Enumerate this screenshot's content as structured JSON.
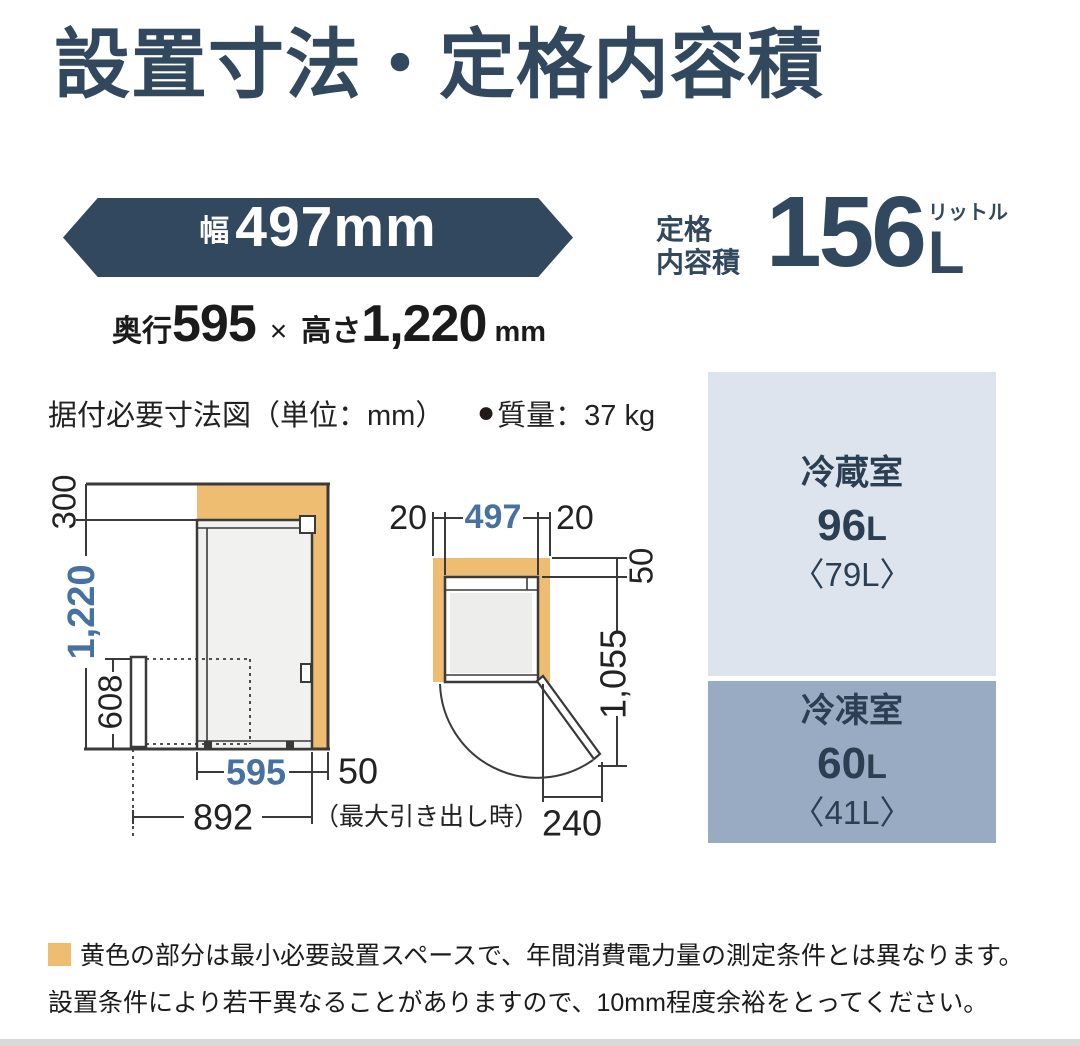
{
  "colors": {
    "accent_navy": "#32485e",
    "accent_blue": "#4671a1",
    "highlight_orange": "#eebd72",
    "fridge_box_bg": "#dde4ee",
    "freezer_box_bg": "#98abc2"
  },
  "header": {
    "title": "設置寸法・定格内容積"
  },
  "width_banner": {
    "label": "幅",
    "value": "497mm"
  },
  "other_dims": {
    "depth_label": "奥行",
    "depth": "595",
    "times": "×",
    "height_label": "高さ",
    "height": "1,220",
    "unit": "mm"
  },
  "capacity": {
    "label_line1": "定格",
    "label_line2": "内容積",
    "value": "156",
    "unit": "L",
    "unit_ruby": "リットル"
  },
  "diagram_header": {
    "caption": "据付必要寸法図（単位：mm）",
    "mass_bullet": "●",
    "mass_label": "質量：37 kg"
  },
  "side_view": {
    "top_clearance": "300",
    "height": "1,220",
    "drawer_height": "608",
    "depth": "595",
    "rear_clearance": "50",
    "max_depth": "892",
    "max_depth_note": "（最大引き出し時）"
  },
  "top_view": {
    "left_clearance": "20",
    "width": "497",
    "right_clearance": "20",
    "rear_clearance": "50",
    "door_open_depth": "1,055",
    "door_protrusion": "240"
  },
  "compartments": {
    "fridge": {
      "name": "冷蔵室",
      "value": "96",
      "unit": "L",
      "alt": "〈79L〉"
    },
    "freezer": {
      "name": "冷凍室",
      "value": "60",
      "unit": "L",
      "alt": "〈41L〉"
    }
  },
  "footnote": {
    "line1": "黄色の部分は最小必要設置スペースで、年間消費電力量の測定条件とは異なります。",
    "line2": "設置条件により若干異なることがありますので、10mm程度余裕をとってください。"
  }
}
